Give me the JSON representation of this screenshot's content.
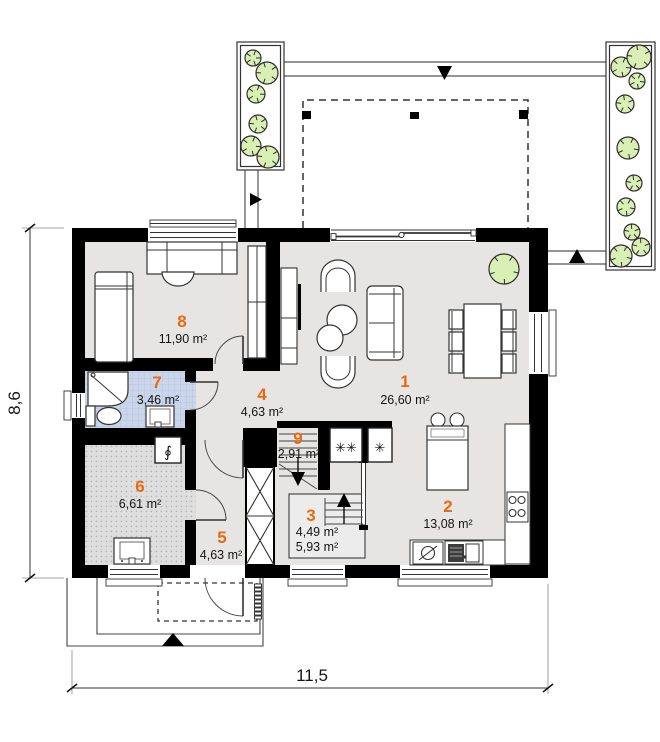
{
  "plan": {
    "rooms": [
      {
        "number": "1",
        "area": "26,60 m²"
      },
      {
        "number": "2",
        "area": "13,08 m²"
      },
      {
        "number": "3",
        "area": "4,49 m²",
        "area2": "5,93 m²"
      },
      {
        "number": "4",
        "area": "4,63 m²"
      },
      {
        "number": "5",
        "area": "4,63 m²"
      },
      {
        "number": "6",
        "area": "6,61 m²"
      },
      {
        "number": "7",
        "area": "3,46 m²"
      },
      {
        "number": "8",
        "area": "11,90 m²"
      },
      {
        "number": "9",
        "area": "2,91 m²"
      }
    ],
    "dimensions": {
      "bottom": "11,5",
      "left": "8,6"
    },
    "symbols": {
      "appliance_pair": "✳✳",
      "appliance_single": "✳",
      "boiler": "∮"
    },
    "colors": {
      "room_number": "#e8690f",
      "wall": "#000000",
      "floor": "#e6e5e3",
      "bathroom_floor": "#ccd6ea",
      "utility_floor": "#dedede",
      "greenery_fill": "#d9efb4",
      "room3_floor": "#ececec"
    }
  }
}
